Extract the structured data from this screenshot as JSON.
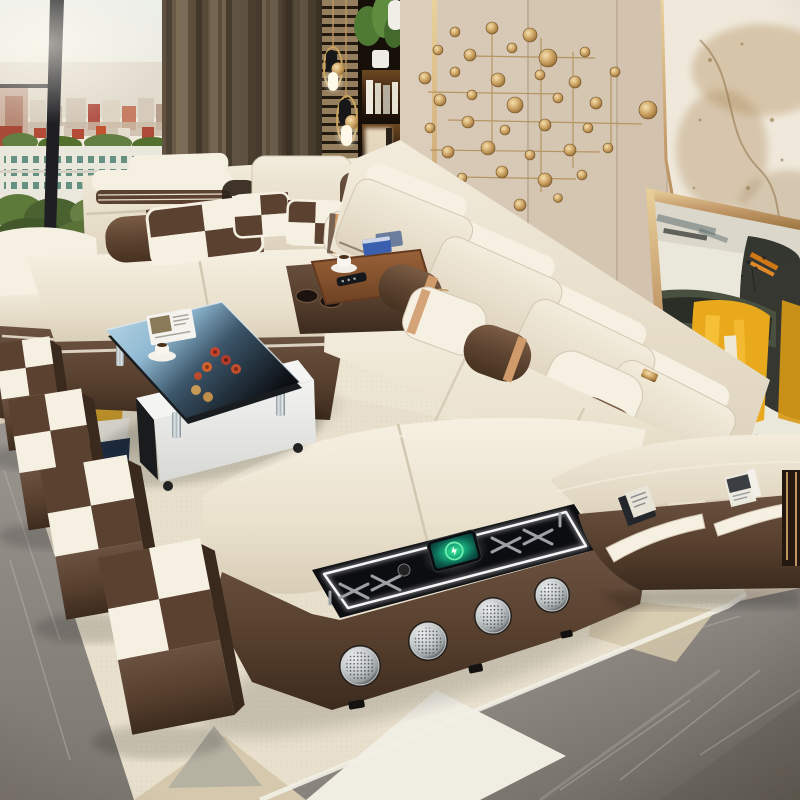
{
  "meta": {
    "title": "Modern living room photograph: cream and chocolate leather U-shaped smart sectional sofa with built-in speakers and wireless charging",
    "media": "photograph"
  },
  "palette": {
    "cream": "#eae2d1",
    "cream_hi": "#f6f0e2",
    "cream_sh": "#d2c7b1",
    "piping": "#5f4f3c",
    "brown": "#5a4130",
    "brown_dark": "#3a2a1e",
    "brown_hi": "#795a43",
    "tan_stripe": "#d09a6b",
    "gold": "#c09660",
    "gold_bright": "#e8cd96",
    "wall_beige": "#d9cab7",
    "curtain": "#6b5c4b",
    "slat_wood": "#b0956f",
    "marble_vein": "#a8895c",
    "paint_yellow": "#e9a91c",
    "paint_black": "#262823",
    "paint_olive": "#49503f",
    "paint_orange": "#d07818",
    "wood": "#8a5636",
    "glass_blue": "#a9cbdf",
    "rug_cream": "#e8e0cc",
    "rug_yellow": "#cf9f2d",
    "rug_navy": "#25374e",
    "rug_white": "#f0ede3",
    "rug_tan": "#d5c8ac",
    "rug_gray": "#b3afa1",
    "floor_gray": "#8e8a85",
    "silver": "#d3d6d7",
    "led": "#ffffff",
    "screen_green": "#2fe08d",
    "tree_green": "#637e41",
    "building_red": "#b34b36"
  },
  "scene": {
    "window": {
      "label": "floor-to-ceiling window with hazy city skyline, red-roof buildings, white tower and green trees"
    },
    "curtain": {
      "label": "taupe brown floor-length curtain"
    },
    "pendant_lights": {
      "label": "two brass and black pendant lights hanging over slatted wood panel",
      "count": 2
    },
    "shelving": {
      "label": "dark built-in display shelving with green plant, white vase, books and lit niche"
    },
    "wall_panels": {
      "label": "beige upholstered wall panels with brass trim seams"
    },
    "wall_decor": {
      "label": "brass disc and rod wall sculpture",
      "disc_count": 37
    },
    "marble_wall": {
      "label": "white and gold veined marble feature slab"
    },
    "painting": {
      "label": "gold-framed abstract painting in yellow, black, olive and white leaning against wall"
    },
    "sofa": {
      "label": "U-shaped modular sectional sofa, cream leather with chocolate leather base and adjustable headrests",
      "sections": [
        "left sofa",
        "corner",
        "right sofa",
        "chaise"
      ],
      "pillow_checkered_count": 3,
      "bolster_count": 5
    },
    "console": {
      "label": "built-in chocolate leather armrest console",
      "cupholders": 2,
      "tray_items": [
        "espresso cup and saucer",
        "remote control",
        "blue card boxes",
        "pen"
      ]
    },
    "tech_panel": {
      "label": "black glass chaise console with white LED edge lighting and wireless charging pad",
      "phone_status": "smartphone wirelessly charging, green charge ring on screen"
    },
    "speakers": {
      "label": "round silver built-in speakers on chaise base",
      "count": 4
    },
    "pockets": {
      "label": "cream-trimmed side storage pockets holding magazines",
      "count": 2,
      "contents": "magazines"
    },
    "coffee_table": {
      "label": "black glass coffee table on white base with chrome legs",
      "items": [
        "open magazine",
        "white coffee cup on saucer",
        "red and tan fruit"
      ]
    },
    "ottomans": {
      "label": "cube ottomans with brown and cream checkered tops",
      "count": 4
    },
    "rug": {
      "label": "cream geometric rug with mustard, navy, white, tan and grey blocks"
    },
    "floor": {
      "label": "grey marble tile floor"
    },
    "side_table": {
      "label": "dark side table with brass legs at right edge"
    }
  }
}
